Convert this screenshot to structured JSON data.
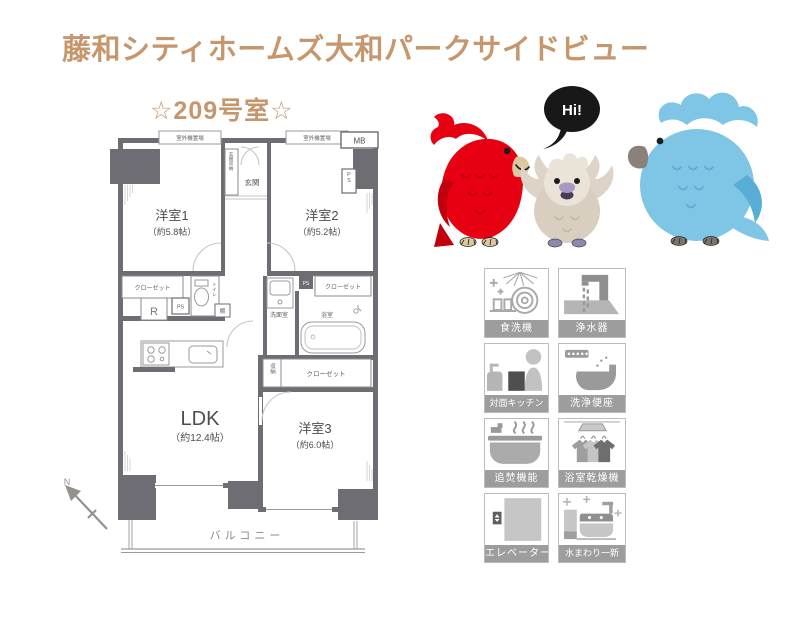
{
  "header": {
    "building_title": "藤和シティホームズ大和パークサイドビュー",
    "room_number": "☆209号室☆",
    "accent_color": "#c6976d"
  },
  "floorplan": {
    "compass": "N",
    "balcony": "バルコニー",
    "rooms": {
      "room1": {
        "name": "洋室1",
        "size": "（約5.8帖）"
      },
      "room2": {
        "name": "洋室2",
        "size": "（約5.2帖）"
      },
      "room3": {
        "name": "洋室3",
        "size": "（約6.0帖）"
      },
      "ldk": {
        "name": "LDK",
        "size": "（約12.4帖）"
      }
    },
    "labels": {
      "outdoor_unit_left": "室外機置場",
      "outdoor_unit_right": "室外機置場",
      "mb": "MB",
      "ps_top": "PS",
      "genkan": "玄関",
      "genkan_storage": "玄関収納",
      "closet_left": "クローゼット",
      "closet_right": "クローゼット",
      "closet_bottom": "クローゼット",
      "ps_left": "PS",
      "ps_mid": "PS",
      "toilet": "トイレ",
      "fridge": "R",
      "shelf": "棚",
      "washroom": "洗面室",
      "bath": "浴室",
      "storage": "収納"
    }
  },
  "mascots": {
    "speech_bubble": "Hi!",
    "colors": {
      "red_parrot": "#e60012",
      "beige_parrot": "#d9cfc1",
      "blue_parrot": "#7fc5e5",
      "bubble": "#181818"
    }
  },
  "amenities": {
    "items": [
      {
        "label": "食洗機"
      },
      {
        "label": "浄水器"
      },
      {
        "label": "対面キッチン"
      },
      {
        "label": "洗浄便座"
      },
      {
        "label": "追焚機能"
      },
      {
        "label": "浴室乾燥機"
      },
      {
        "label": "エレベーター"
      },
      {
        "label": "水まわり一新"
      }
    ],
    "label_band_color": "#9d9d9d"
  }
}
